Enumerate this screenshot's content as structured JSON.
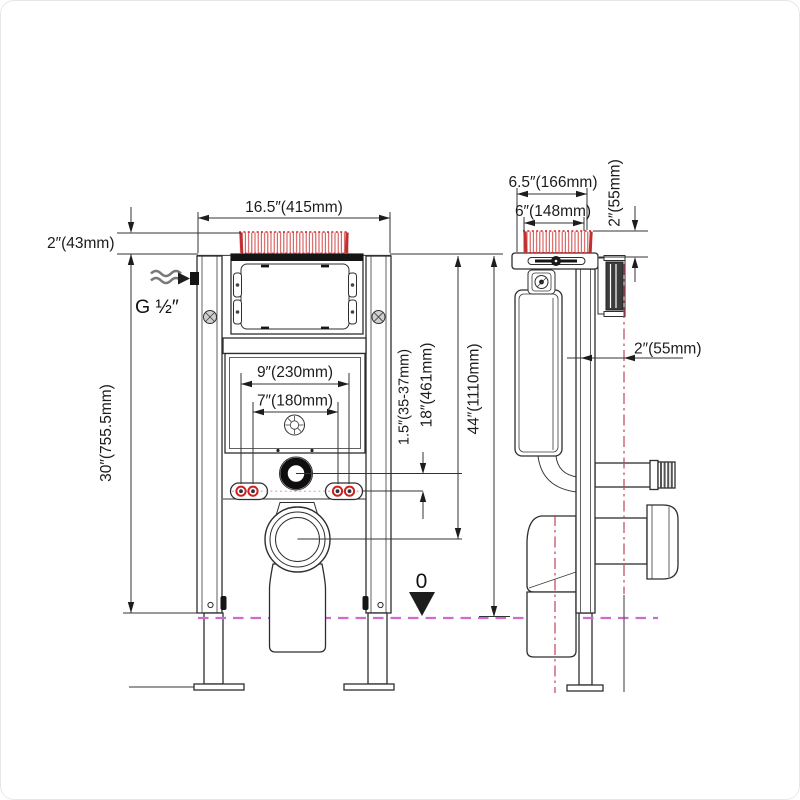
{
  "colors": {
    "line": "#2e2e2e",
    "hatch_red": "#cc2222",
    "floor_line": "#cf6bcf",
    "centerline_red": "#c2435a"
  },
  "front_view": {
    "top_width_label": "16.5″(415mm)",
    "plate_offset_label": "2″(43mm)",
    "water_inlet_label": "G ½″",
    "bolt_spacing_outer_label": "9″(230mm)",
    "bolt_spacing_inner_label": "7″(180mm)",
    "frame_height_label": "30″(755.5mm)",
    "supply_gap_label": "1.5″(35-37mm)",
    "mid_height_label": "18″(461mm)",
    "total_height_label": "44″(1110mm)",
    "floor_datum_label": "0"
  },
  "side_view": {
    "depth_outer_label": "6.5″(166mm)",
    "depth_inner_label": "6″(148mm)",
    "recess_height_label": "2″(55mm)",
    "wall_offset_label": "2″(55mm)"
  }
}
